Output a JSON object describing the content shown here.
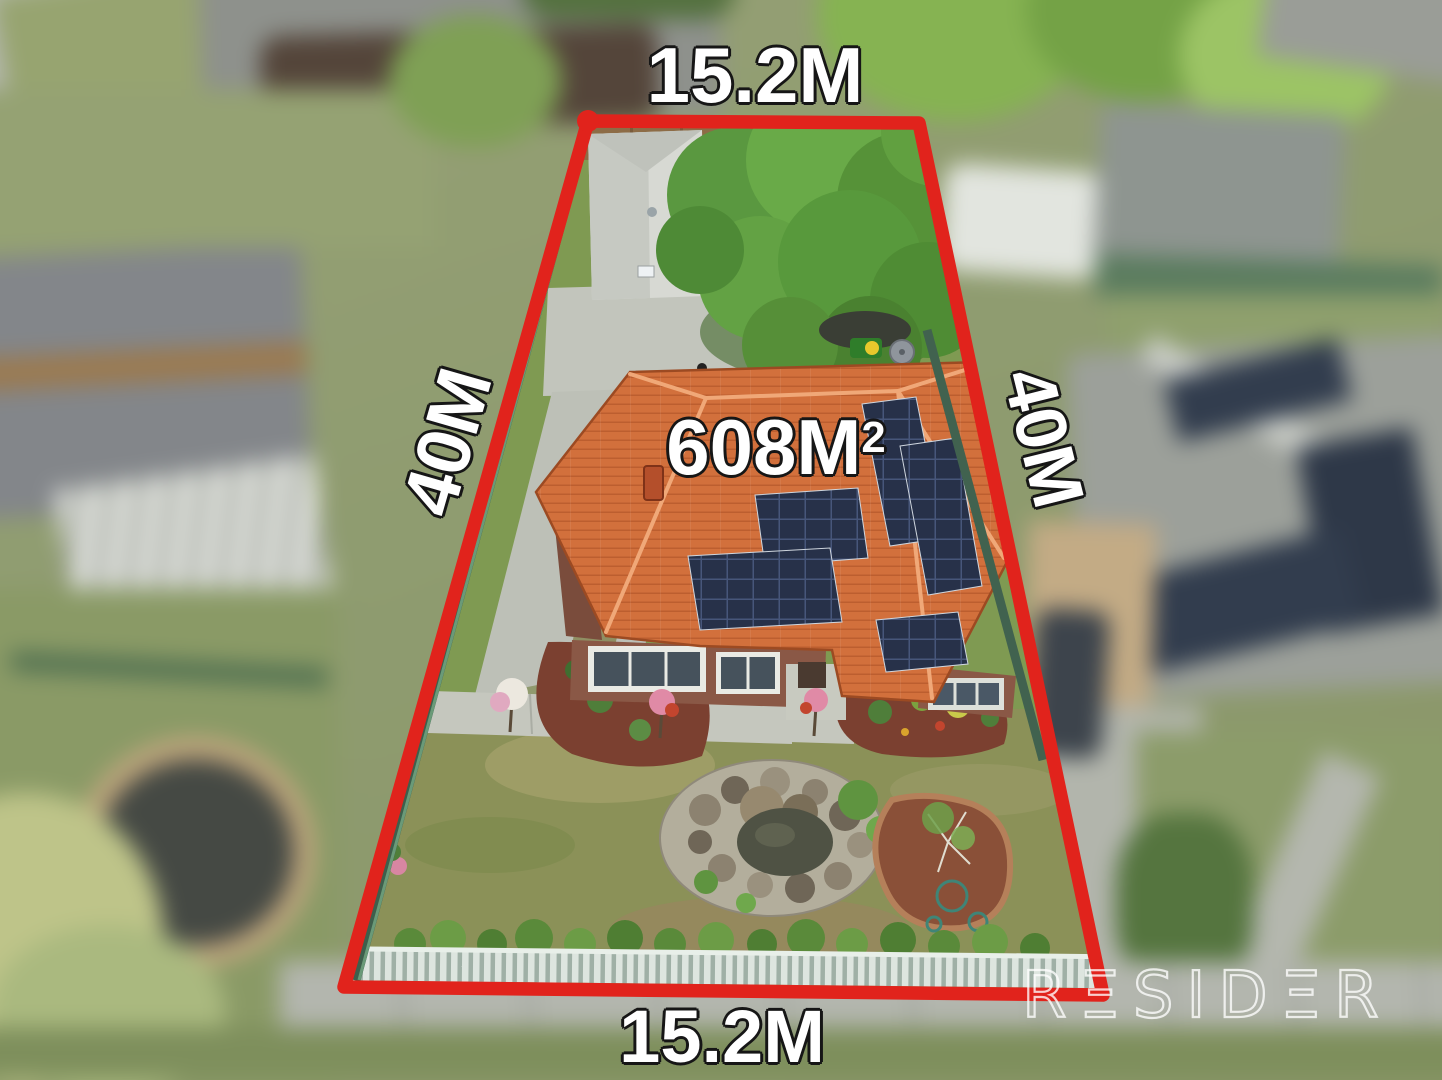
{
  "overlay": {
    "top_width": "15.2M",
    "bottom_width": "15.2M",
    "left_depth": "40M",
    "right_depth": "40M",
    "area": "608M",
    "area_exponent": "2"
  },
  "watermark": {
    "brand": "RESIDER",
    "styled_text": "RΞSIDΞR"
  },
  "colors": {
    "boundary": "#e1231c",
    "label_fill": "#ffffff",
    "label_outline": "#161616",
    "roof_tile": "#d2703c",
    "solar_panel": "#273149",
    "front_lawn": "#8b9158",
    "driveway": "#bdc0b7",
    "green_fence": "#3e5f4c",
    "mulch": "#7b4030"
  }
}
